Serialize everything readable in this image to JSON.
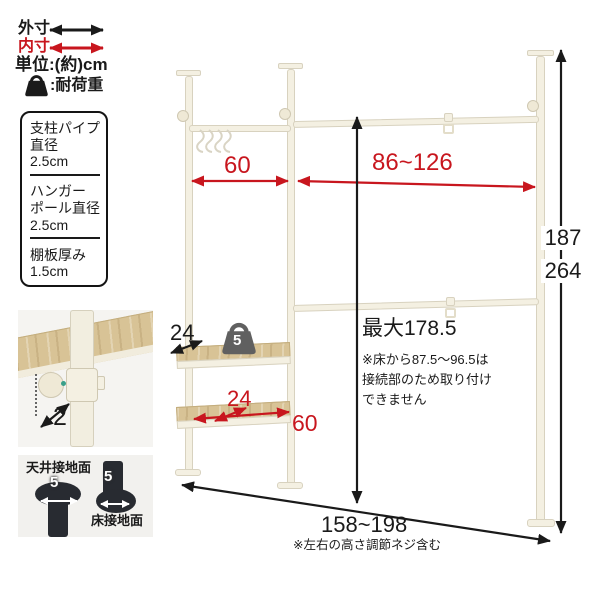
{
  "colors": {
    "accent_red": "#c8161e",
    "ink": "#1a1a1a",
    "pole_cream": "#f4f0e2",
    "wood": "#d8c396",
    "hardware_black": "#282b31"
  },
  "legend": {
    "outer": "外寸",
    "inner": "内寸",
    "unit": "単位:(約)cm",
    "load": ":耐荷重"
  },
  "spec_box": {
    "sections": [
      {
        "lines": [
          "支柱パイプ",
          "直径",
          "2.5cm"
        ]
      },
      {
        "lines": [
          "ハンガー",
          "ポール直径",
          "2.5cm"
        ]
      },
      {
        "lines": [
          "棚板厚み",
          "1.5cm"
        ]
      }
    ]
  },
  "dimensions": {
    "left_hanger_width": "60",
    "right_hanger_width": "86~126",
    "height_min": "187",
    "height_max": "264",
    "max_pole_height": "最大178.5",
    "max_pole_note": [
      "※床から87.5〜96.5は",
      "接続部のため取り付け",
      "できません"
    ],
    "top_shelf_depth": "24",
    "shelf_load": "5",
    "bottom_shelf_depth": "24",
    "bottom_shelf_width": "60",
    "clamp_offset": "2",
    "total_width": "158~198",
    "total_width_note": "※左右の高さ調節ネジ含む"
  },
  "pads": {
    "ceiling_label": "天井接地面",
    "ceiling_size": "5",
    "floor_label": "床接地面",
    "floor_size": "5"
  }
}
